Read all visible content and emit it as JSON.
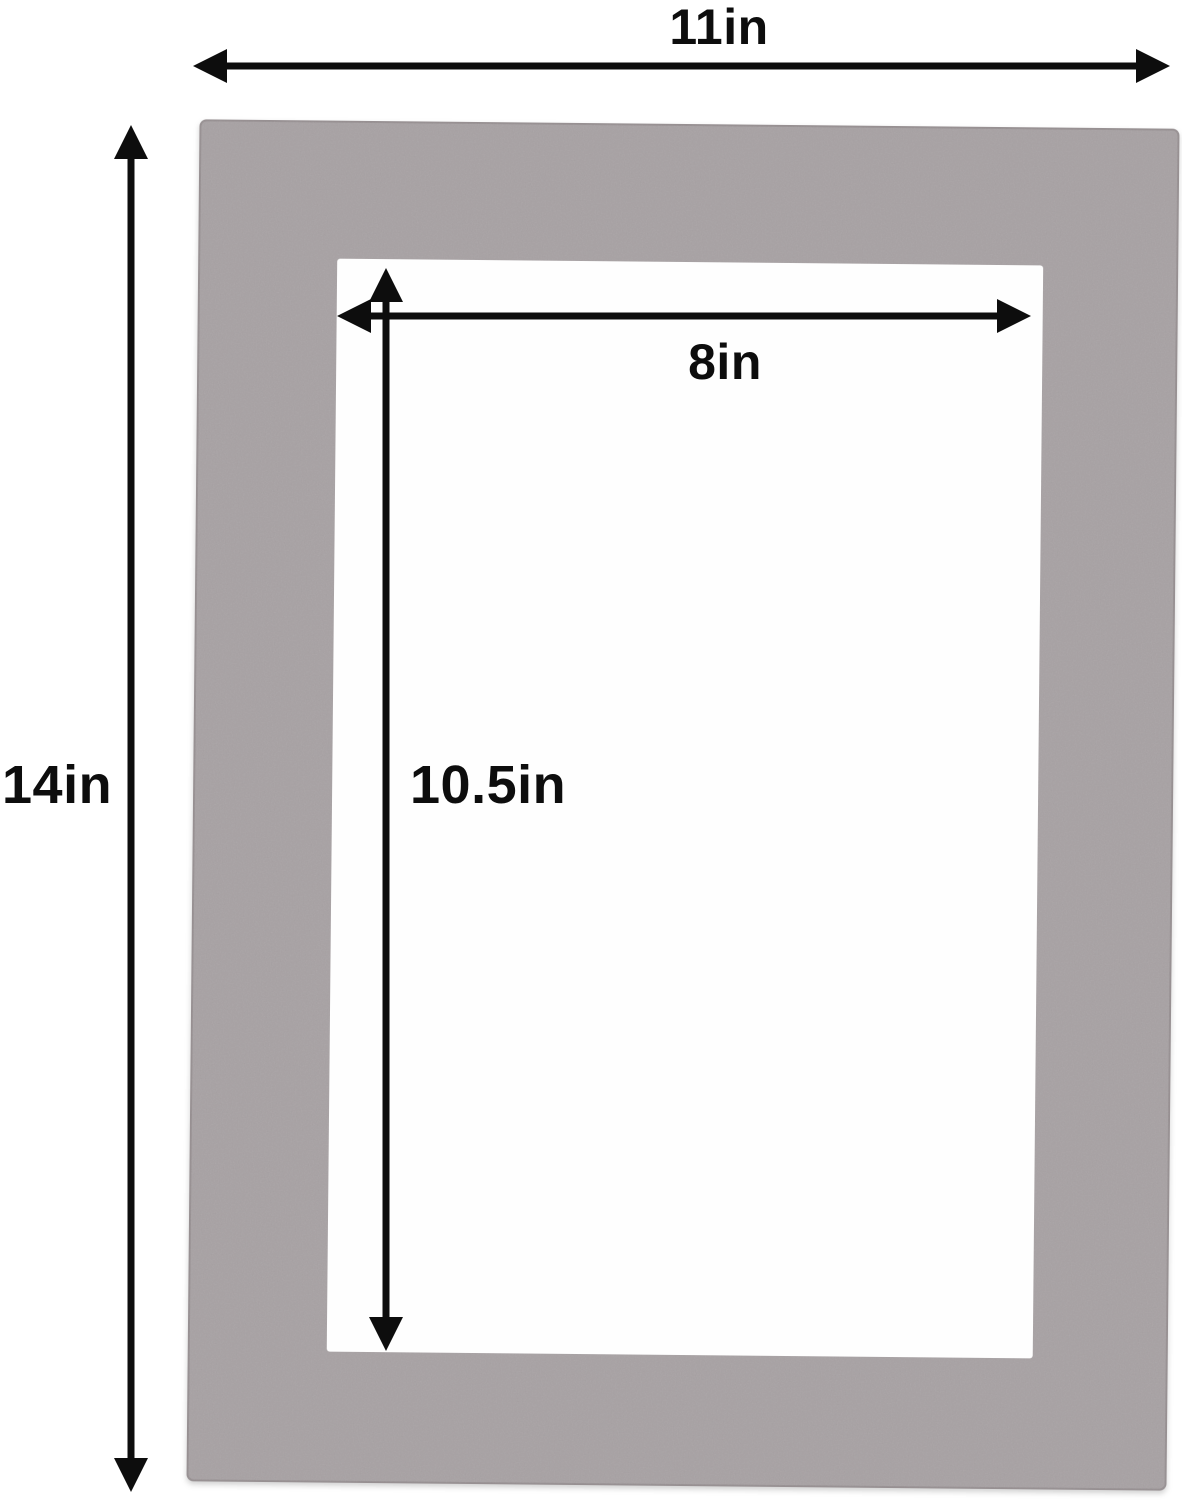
{
  "colors": {
    "background": "#ffffff",
    "mat_board": "#a7a1a3",
    "mat_edge": "#979092",
    "opening": "#fefefe",
    "dimension_lines": "#0d0d0d"
  },
  "mat": {
    "outer_width_label": "11in",
    "outer_height_label": "14in",
    "opening_width_label": "8in",
    "opening_height_label": "10.5in"
  }
}
